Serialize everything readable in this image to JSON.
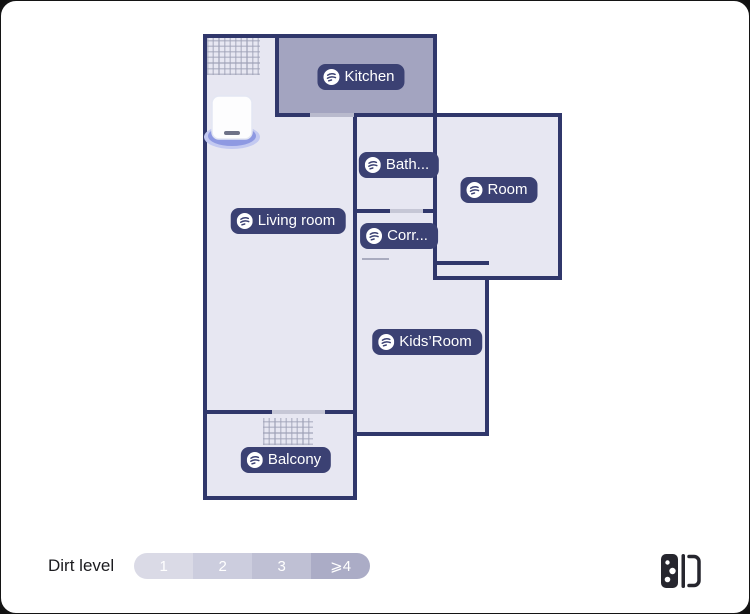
{
  "map": {
    "rooms": {
      "kitchen": {
        "label": "Kitchen",
        "dirt_shaded": true,
        "fill": "#a3a4c0"
      },
      "bathroom": {
        "label": "Bath...",
        "dirt_shaded": false,
        "fill": "#e7e7f2"
      },
      "room": {
        "label": "Room",
        "dirt_shaded": false,
        "fill": "#e7e7f2"
      },
      "living_room": {
        "label": "Living room",
        "dirt_shaded": false,
        "fill": "#e7e7f2"
      },
      "corridor": {
        "label": "Corr...",
        "dirt_shaded": false,
        "fill": "#e7e7f2"
      },
      "kids_room": {
        "label": "Kids’Room",
        "dirt_shaded": false,
        "fill": "#e7e7f2"
      },
      "balcony": {
        "label": "Balcony",
        "dirt_shaded": false,
        "fill": "#e7e7f2"
      }
    },
    "colors": {
      "wall": "#30376b",
      "floor": "#e7e7f2",
      "label_pill": "#3b4173",
      "dock_base": "#8e99e2"
    },
    "markers": {
      "dock": "base-station-dock",
      "carpets": [
        "living-room-top-left",
        "balcony"
      ]
    }
  },
  "legend": {
    "title": "Dirt level",
    "levels": [
      {
        "label": "1",
        "color": "#dadae6"
      },
      {
        "label": "2",
        "color": "#cccdde"
      },
      {
        "label": "3",
        "color": "#bfc0d4"
      },
      {
        "label": "⩾4",
        "color": "#abacc6"
      }
    ]
  },
  "toolbar": {
    "map_switch_icon": "split-map-icon"
  }
}
